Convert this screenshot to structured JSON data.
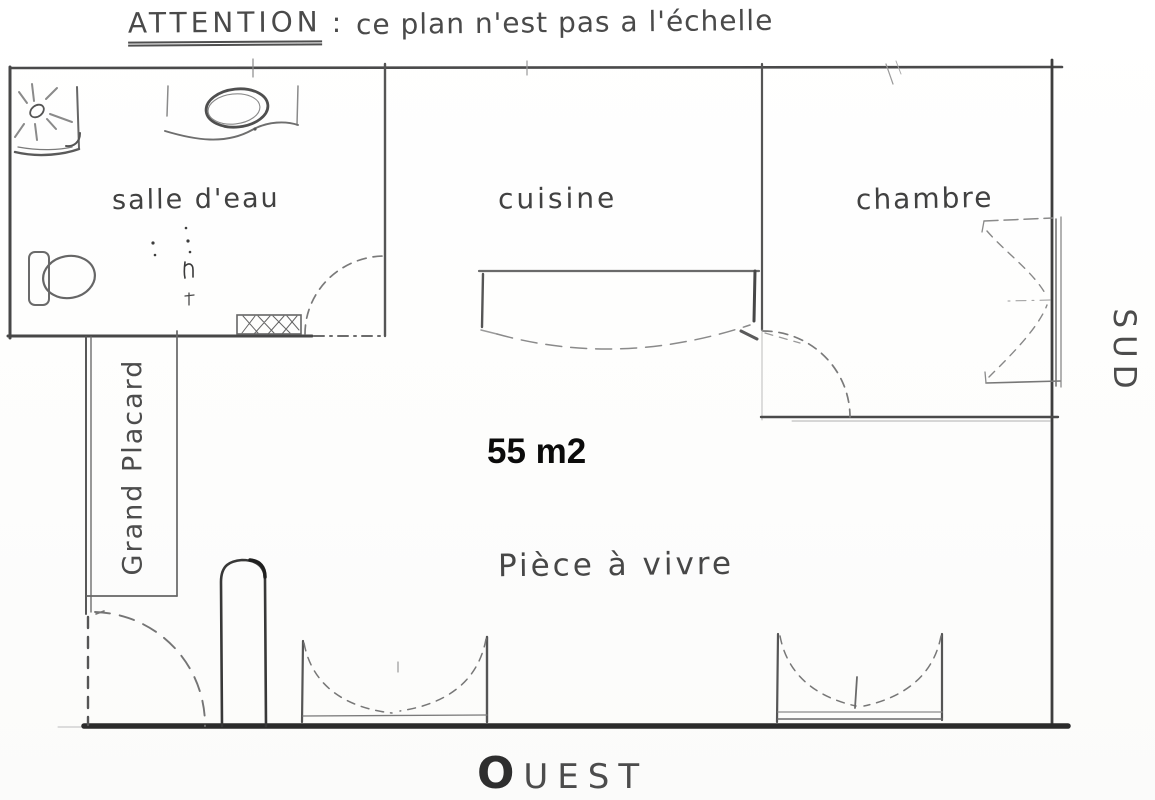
{
  "notice": {
    "emphasis": "ATTENTION",
    "separator": ":",
    "text": "ce plan n'est pas a l'échelle"
  },
  "rooms": {
    "bathroom": "salle d'eau",
    "kitchen": "cuisine",
    "bedroom": "chambre",
    "closet": "Grand Placard",
    "living_room": "Pièce à vivre"
  },
  "area_label": "55 m2",
  "compass": {
    "south": "SUD",
    "west": "OUEST"
  },
  "icons": {
    "shower": "square tray with drain and spray rays",
    "washbasin": "oval basin on counter",
    "toilet": "tank and bowl",
    "radiator": "cross-hatched rectangle",
    "water_heater": "rounded column",
    "door_swing": "dashed quarter-circle arc",
    "french_window": "double dashed casement arcs"
  },
  "colors": {
    "pencil": "#6a6a6a",
    "pencil_dark": "#3c3c3c",
    "wall": "#474747",
    "heavy_wall": "#2b2b2b",
    "annotation": "#0d0d0d",
    "paper": "#fdfdfc"
  }
}
